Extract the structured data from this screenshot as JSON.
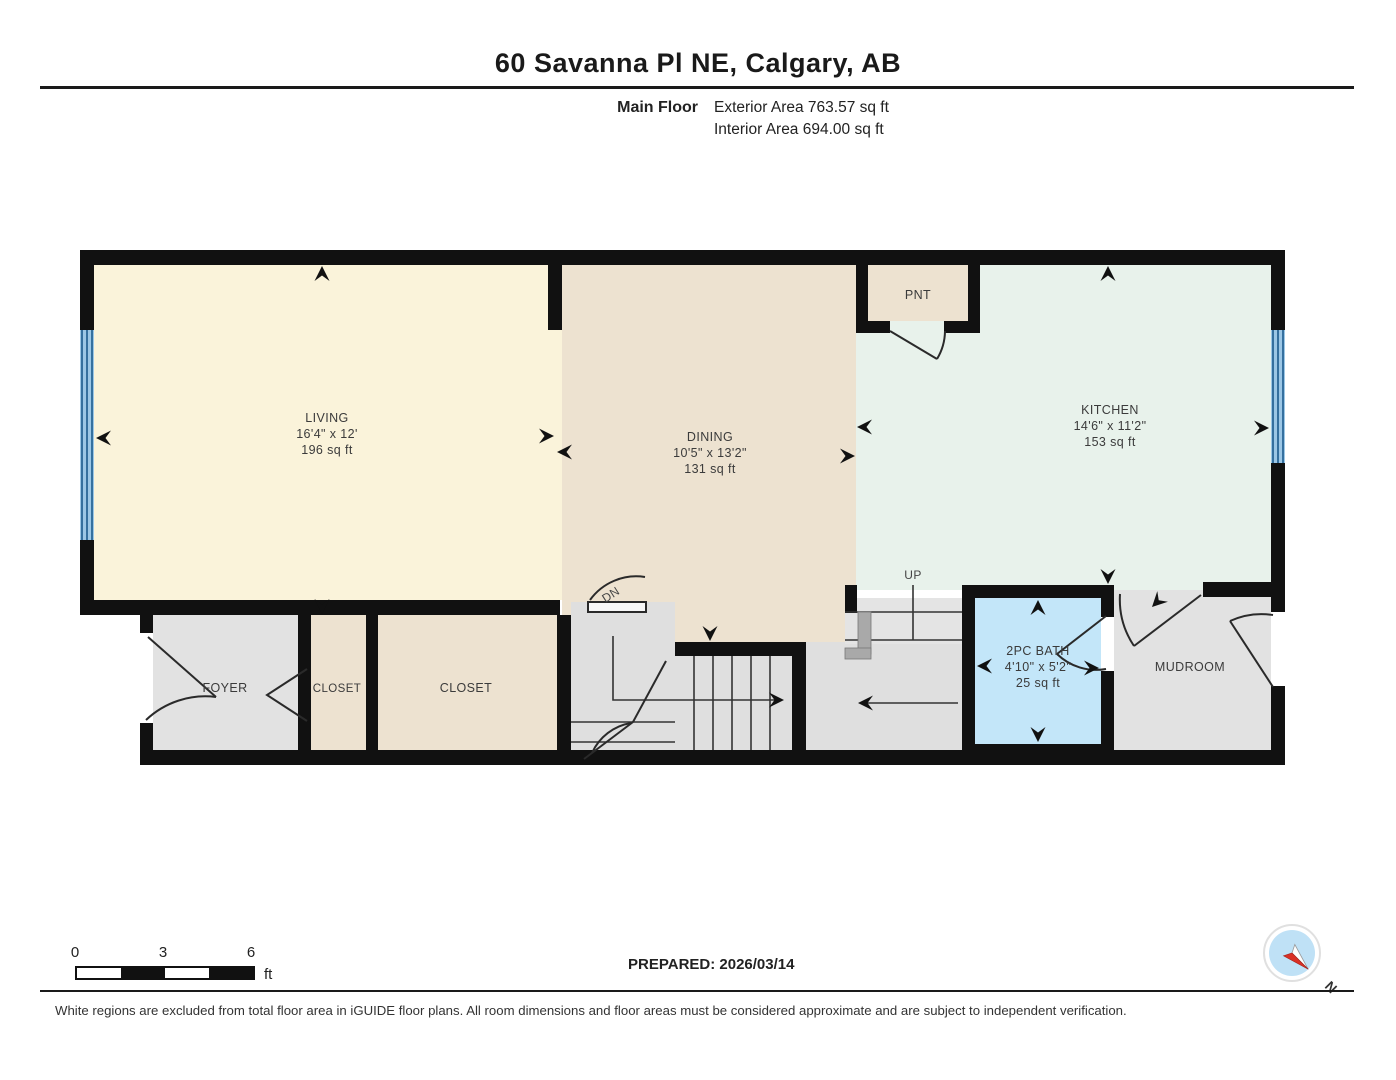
{
  "header": {
    "title": "60 Savanna Pl NE, Calgary, AB",
    "floor_label": "Main Floor",
    "exterior_area": "Exterior Area 763.57 sq ft",
    "interior_area": "Interior Area 694.00 sq ft"
  },
  "plan": {
    "rooms": {
      "living": {
        "name": "LIVING",
        "dims": "16'4\" x 12'",
        "area": "196 sq ft"
      },
      "dining": {
        "name": "DINING",
        "dims": "10'5\" x 13'2\"",
        "area": "131 sq ft"
      },
      "kitchen": {
        "name": "KITCHEN",
        "dims": "14'6\" x 11'2\"",
        "area": "153 sq ft"
      },
      "bath": {
        "name": "2PC BATH",
        "dims": "4'10\" x 5'2\"",
        "area": "25 sq ft"
      },
      "pantry": {
        "name": "PNT"
      },
      "foyer": {
        "name": "FOYER"
      },
      "closet1": {
        "name": "CLOSET"
      },
      "closet2": {
        "name": "CLOSET"
      },
      "mudroom": {
        "name": "MUDROOM"
      },
      "stairs_up": {
        "name": "UP"
      },
      "stairs_dn": {
        "name": "DN"
      }
    }
  },
  "scale_bar": {
    "ticks": [
      "0",
      "3",
      "6"
    ],
    "unit": "ft"
  },
  "footer": {
    "prepared": "PREPARED: 2026/03/14",
    "disclaimer": "White regions are excluded from total floor area in iGUIDE floor plans. All room dimensions and floor areas must be considered approximate and are subject to independent verification.",
    "compass_north": "N"
  },
  "colors": {
    "wall": "#111111",
    "living": "#FAF3DA",
    "dining_closet": "#EDE2D0",
    "kitchen": "#E8F2EB",
    "bath": "#C3E6F9",
    "gray_room": "#E2E2E2",
    "stairs": "#DFDFDF",
    "window_blue": "#9CC7E6",
    "window_stripe": "#35709F",
    "compass_red": "#D93025",
    "compass_blue": "#BFE1F6"
  }
}
